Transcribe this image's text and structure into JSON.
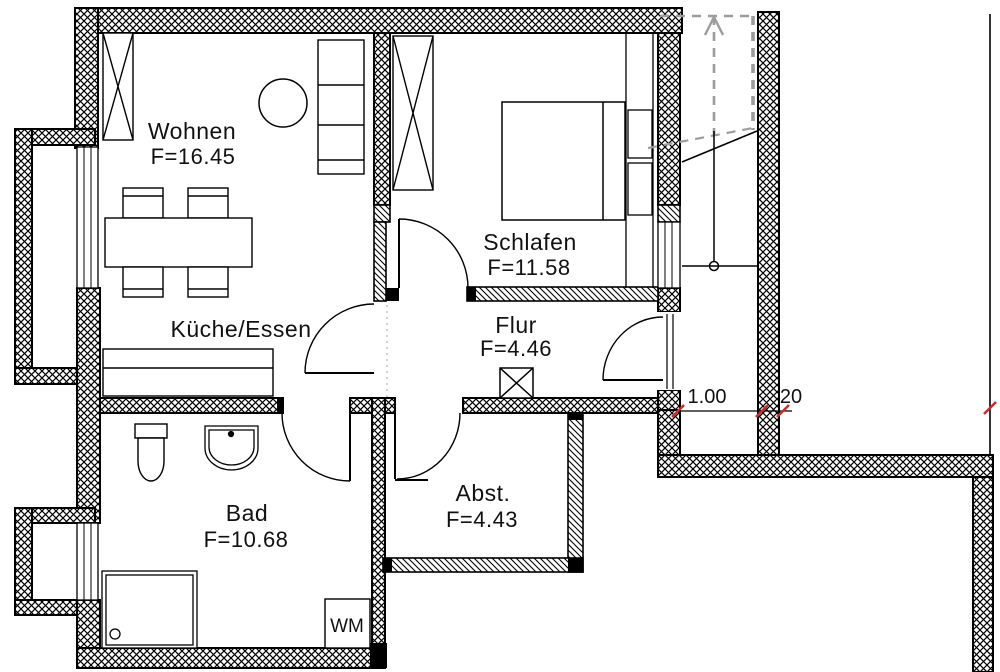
{
  "plan": {
    "rooms": [
      {
        "name": "Wohnen",
        "area": "F=16.45"
      },
      {
        "name": "Schlafen",
        "area": "F=11.58"
      },
      {
        "name": "Küche/Essen",
        "area": ""
      },
      {
        "name": "Flur",
        "area": "F=4.46"
      },
      {
        "name": "Bad",
        "area": "F=10.68"
      },
      {
        "name": "Abst.",
        "area": "F=4.43"
      }
    ],
    "appliances": {
      "washing_machine": "WM"
    },
    "dimensions": {
      "corridor_width": "1.00",
      "wall_thickness": "20"
    },
    "symbols": {
      "wardrobe": "rect-with-x",
      "shaft": "square-with-x",
      "stair_direction": "up-arrow-dashed"
    },
    "colors": {
      "wall": "#000000",
      "stair_dashed": "#9c9c9c",
      "dimension_tick": "#c03030",
      "background": "#ffffff"
    }
  }
}
